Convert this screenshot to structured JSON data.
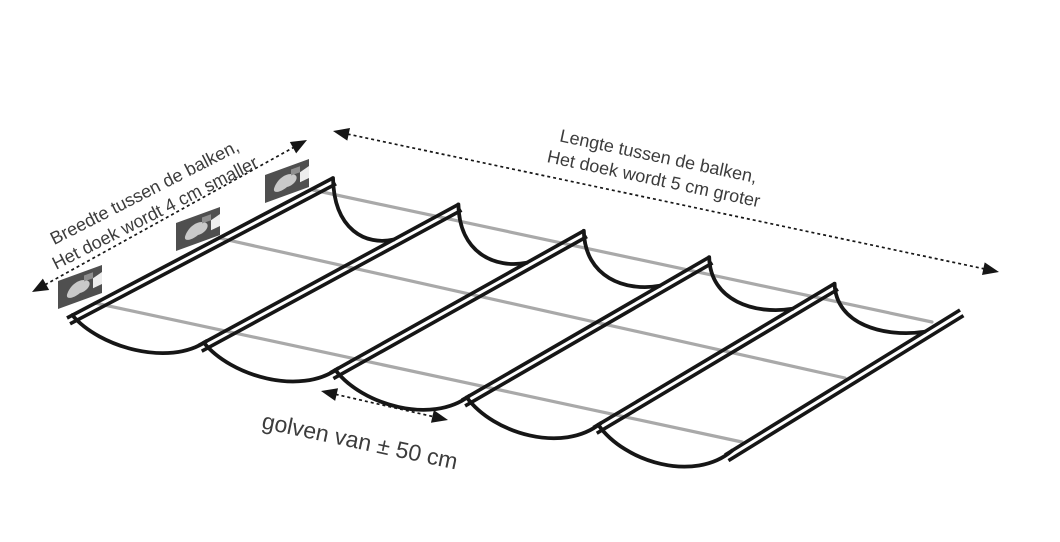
{
  "diagram": {
    "labels": {
      "width_line1": "Breedte tussen de balken,",
      "width_line2": "Het doek wordt 4 cm smaller",
      "length_line1": "Lengte tussen de balken,",
      "length_line2": "Het doek wordt 5 cm groter",
      "wave": "golven van ± 50 cm"
    },
    "colors": {
      "ink": "#161616",
      "cable": "#a9a9a9",
      "text": "#3c3c3c",
      "background": "#ffffff",
      "photo_dark": "#4f4f4f",
      "photo_mid": "#8f8f8f",
      "photo_light": "#c9c9c9",
      "photo_highlight": "#ededed"
    },
    "structure": {
      "rail_count": 6,
      "wave_count": 5,
      "cable_count": 3,
      "pulley_count": 3
    }
  }
}
